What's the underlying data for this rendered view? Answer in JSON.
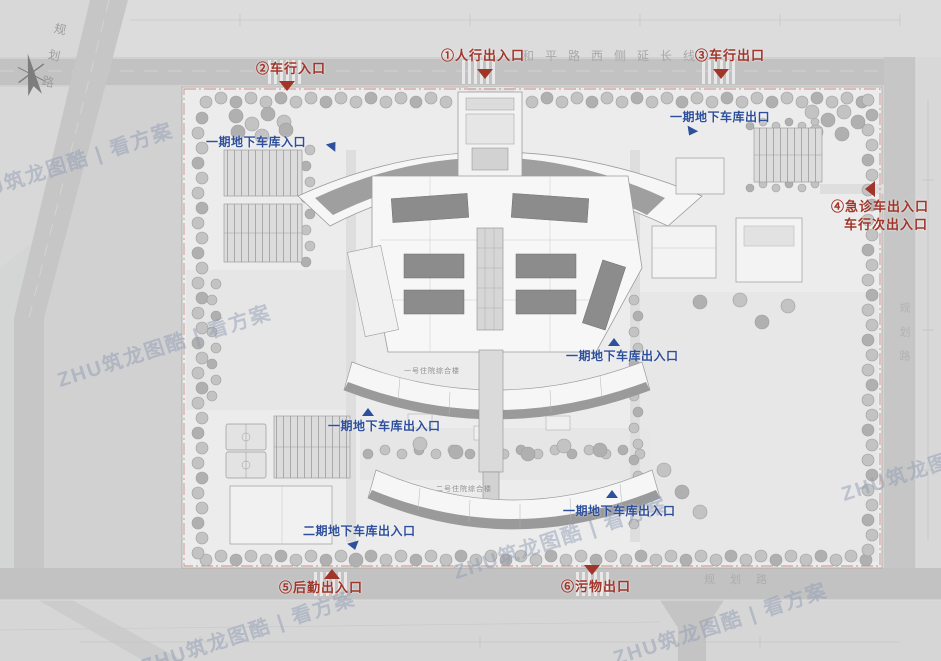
{
  "title": "医院总平面图（出入口标注）",
  "roads": {
    "top": "和平路西侧延长线",
    "left": "规划路",
    "right": "规划路",
    "bottom": "规划路"
  },
  "entrances": [
    {
      "num": "①",
      "text": "①人行出入口"
    },
    {
      "num": "②",
      "text": "②车行入口"
    },
    {
      "num": "③",
      "text": "③车行出口"
    },
    {
      "num": "④",
      "text": "④急诊车出入口",
      "text2": "车行次出入口"
    },
    {
      "num": "⑤",
      "text": "⑤后勤出入口"
    },
    {
      "num": "⑥",
      "text": "⑥污物出口"
    }
  ],
  "garages": [
    {
      "text": "一期地下车库入口"
    },
    {
      "text": "一期地下车库出口"
    },
    {
      "text": "一期地下车库出入口"
    },
    {
      "text": "一期地下车库出入口"
    },
    {
      "text": "一期地下车库出入口"
    },
    {
      "text": "二期地下车库出入口"
    }
  ],
  "buildings": [
    {
      "name": "一号住院综合楼"
    },
    {
      "name": "二号住院综合楼"
    }
  ],
  "watermark": {
    "text": "ZHU筑龙图酷 | 看方案"
  },
  "colors": {
    "entrance_red": "#a0352a",
    "garage_blue": "#2e4f9b",
    "boundary_red": "#b85c4e",
    "road_gray": "#c2c2c2",
    "site_gray": "#ececec",
    "building_white": "#f6f6f6",
    "slab_gray": "#8c8c8c"
  }
}
